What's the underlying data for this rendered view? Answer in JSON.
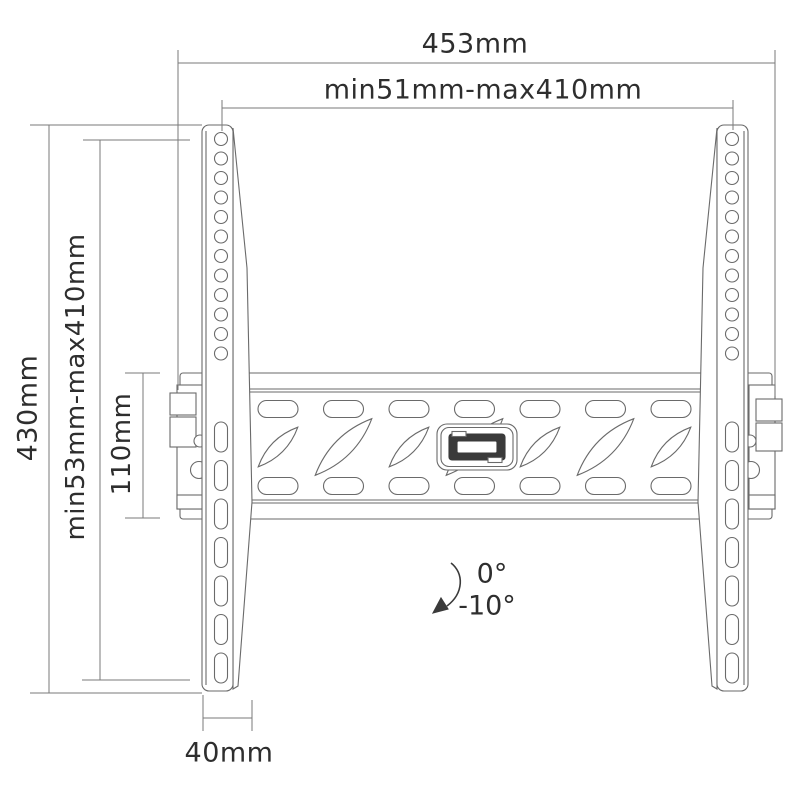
{
  "drawing": {
    "type": "technical-diagram",
    "subject": "Tilting TV wall-mount bracket, front view with dimension annotations",
    "labels": {
      "overall_width": "453mm",
      "hole_pattern_width": "min51mm-max410mm",
      "overall_height": "430mm",
      "hole_pattern_height": "min53mm-max410mm",
      "rail_height": "110mm",
      "arm_width": "40mm",
      "tilt_max": "0°",
      "tilt_min": "-10°"
    },
    "colors": {
      "line": "#6a6a6a",
      "dimension_line": "#7a7a7a",
      "text": "#2e2e2e",
      "background": "#ffffff",
      "latch_fill": "#3a3a3a"
    }
  }
}
